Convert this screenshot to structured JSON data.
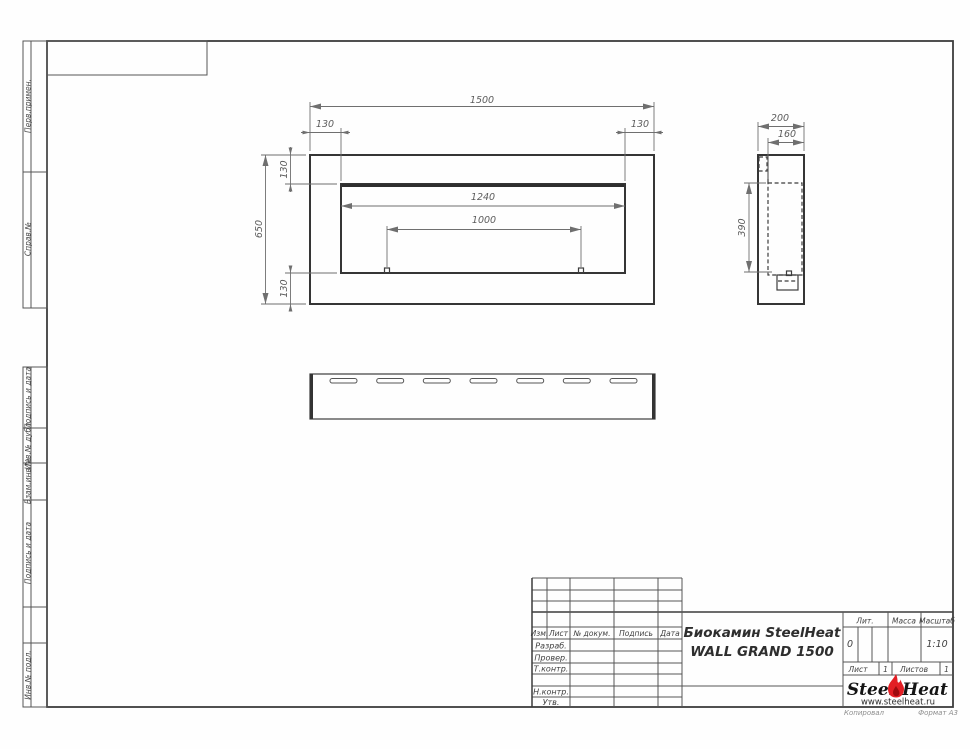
{
  "dims": {
    "front_width": "1500",
    "front_left": "130",
    "front_right": "130",
    "front_height": "650",
    "front_top": "130",
    "front_bottom": "130",
    "opening_width": "1240",
    "burner_width": "1000",
    "side_depth": "200",
    "side_inner": "160",
    "side_opening_height": "390"
  },
  "margins": {
    "top": [
      "Перв.примен.",
      "Справ.№"
    ],
    "bottom": [
      "Подпись и дата",
      "Инв.№ дубл.",
      "Взам.инв.№",
      "Подпись и дата",
      "Инв.№ подл."
    ]
  },
  "title_block": {
    "header_cols": [
      "Изм.",
      "Лист",
      "№ докум.",
      "Подпись",
      "Дата"
    ],
    "row_labels": [
      "Разраб.",
      "Провер.",
      "Т.контр.",
      "Н.контр.",
      "Утв."
    ],
    "title_line1": "Биокамин SteelHeat",
    "title_line2": "WALL GRAND 1500",
    "lit_label": "Лит.",
    "lit_value": "0",
    "mass_label": "Масса",
    "scale_label": "Масштаб",
    "scale_value": "1:10",
    "sheet_label": "Лист",
    "sheet_value": "1",
    "sheets_label": "Листов",
    "sheets_value": "1",
    "logo_part1": "Steel",
    "logo_part2": "Heat",
    "logo_url": "www.steelheat.ru",
    "footer_left": "Копировал",
    "footer_right": "Формат А3"
  },
  "colors": {
    "flame_red": "#e31e24",
    "flame_dark": "#9e0b0f",
    "line": "#3c3c3c",
    "dim": "#6f6f6f"
  }
}
